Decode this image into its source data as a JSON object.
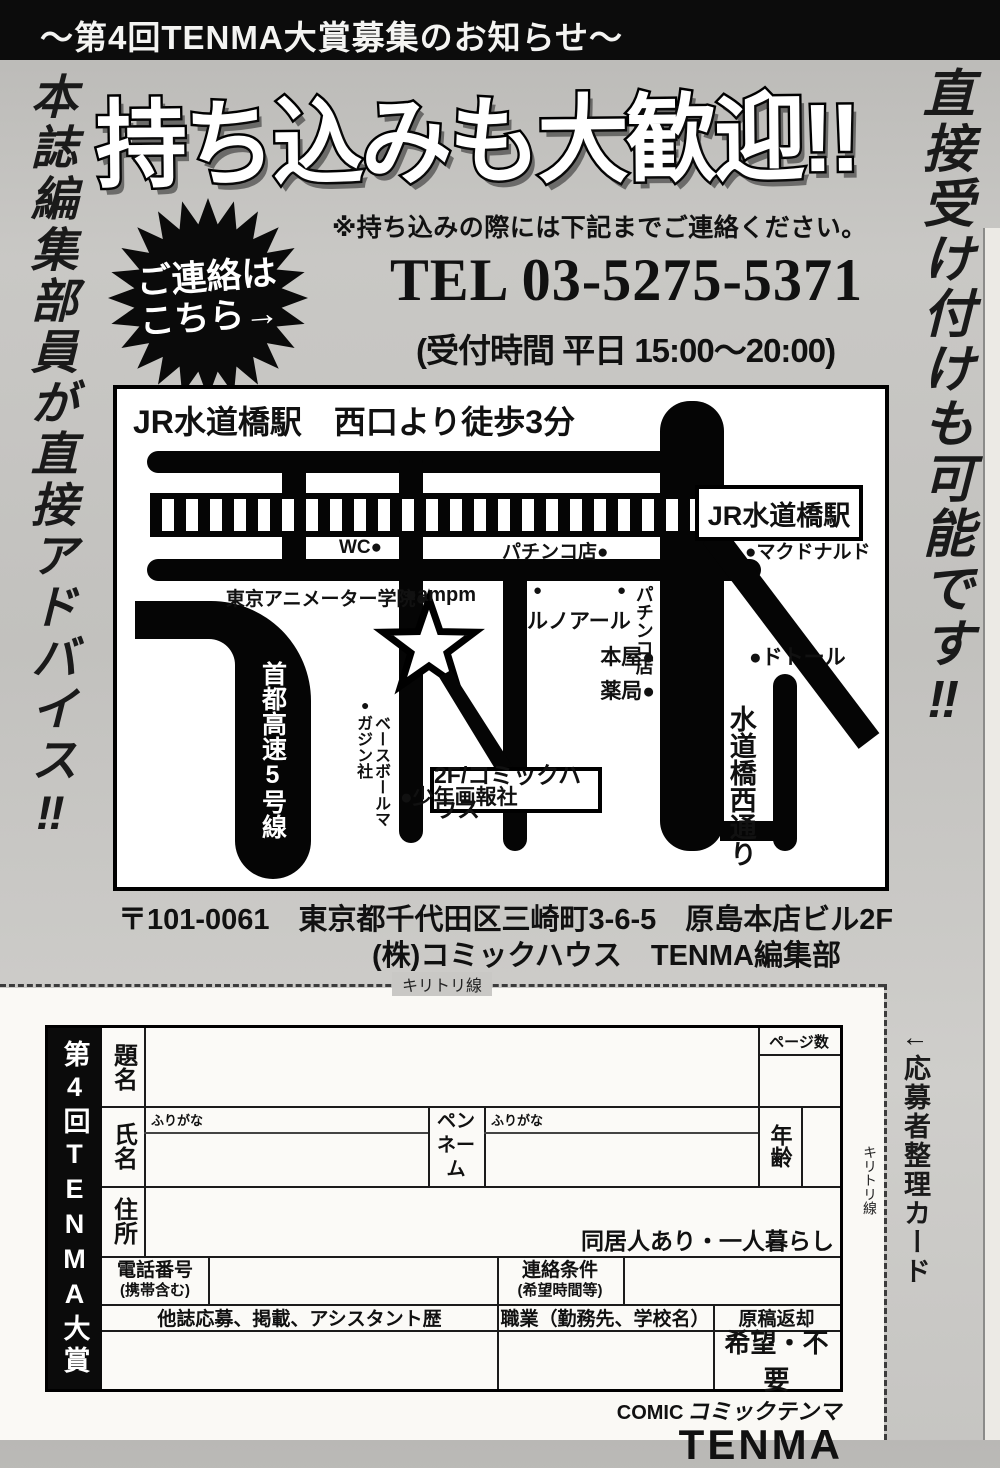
{
  "banner": {
    "text": "～第4回TENMA大賞募集のお知らせ～"
  },
  "headlines": {
    "left": "本誌編集部員が直接アドバイス‼",
    "right": "直接受け付けも可能です‼",
    "main": "持ち込みも大歓迎!!",
    "note": "※持ち込みの際には下記までご連絡ください。",
    "burst_line1": "ご連絡は",
    "burst_line2": "こちら→",
    "tel": "TEL 03-5275-5371",
    "hours": "(受付時間 平日 15:00～20:00)"
  },
  "map": {
    "title": "JR水道橋駅　西口より徒歩3分",
    "station": "JR水道橋駅",
    "wc": "WC●",
    "pachinko_top": "パチンコ店●",
    "mcdonalds": "●マクドナルド",
    "animator_school": "東京アニメーター学院●",
    "ampm": "●ampm",
    "renoir_dot1": "●",
    "renoir_dot2": "●",
    "renoir": "ルノアール",
    "pachinko_side": "パチンコ店",
    "bookstore": "本屋●",
    "doutor": "●ドトール",
    "pharmacy": "薬局●",
    "destination": "2F/コミックハウス",
    "street": "水道橋西通り",
    "expressway": "首都高速5号線",
    "baseball_dot": "●",
    "baseball": "ベースボールマガジン社",
    "shonen": "●少年画報社"
  },
  "address": {
    "line1": "〒101-0061　東京都千代田区三崎町3-6-5　原島本店ビル2F",
    "line2": "(株)コミックハウス　TENMA編集部"
  },
  "cut": {
    "horizontal": "キリトリ線",
    "vertical": "キリトリ線",
    "side_note": "←応募者整理カード"
  },
  "form": {
    "award": "第4回TENMA大賞",
    "title_label": "題名",
    "pages_label": "ページ数",
    "furigana1": "ふりがな",
    "furigana2": "ふりがな",
    "name_label": "氏名",
    "penname_l1": "ペン",
    "penname_l2": "ネーム",
    "age_label": "年齢",
    "address_label": "住所",
    "living_note": "同居人あり・一人暮らし",
    "phone_l1": "電話番号",
    "phone_l2": "(携帯含む)",
    "contact_l1": "連絡条件",
    "contact_l2": "(希望時間等)",
    "history_label": "他誌応募、掲載、アシスタント歴",
    "occupation_label": "職業（勤務先、学校名）",
    "return_label": "原稿返却",
    "return_options": "希望・不要"
  },
  "logo": {
    "comic": "COMIC",
    "kana": "コミックテンマ",
    "tenma": "TENMA"
  }
}
